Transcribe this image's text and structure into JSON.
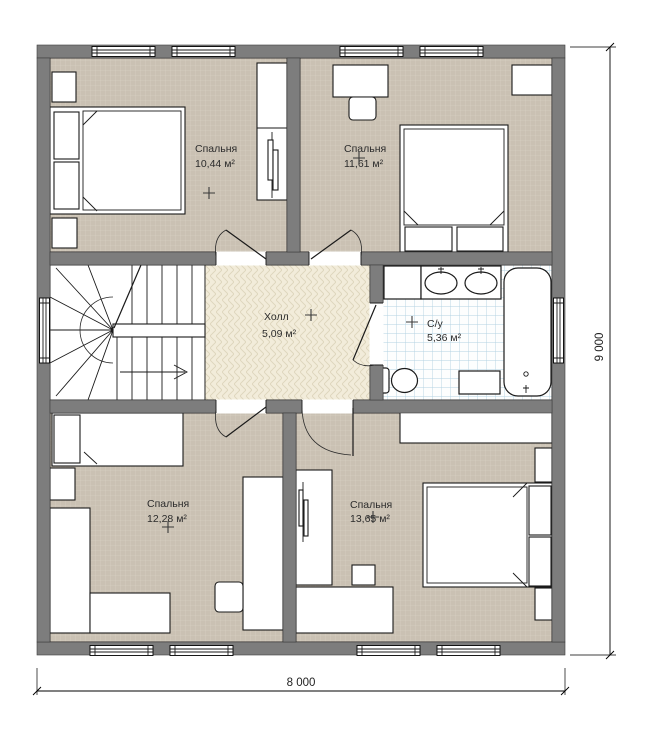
{
  "plan": {
    "rooms": [
      {
        "key": "bedroom-top-left",
        "name": "Спальня",
        "area": "10,44 м²"
      },
      {
        "key": "bedroom-top-right",
        "name": "Спальня",
        "area": "11,61 м²"
      },
      {
        "key": "hall",
        "name": "Холл",
        "area": "5,09 м²"
      },
      {
        "key": "bathroom",
        "name": "С/у",
        "area": "5,36 м²"
      },
      {
        "key": "bedroom-bottom-left",
        "name": "Спальня",
        "area": "12,28 м²"
      },
      {
        "key": "bedroom-bottom-right",
        "name": "Спальня",
        "area": "13,65 м²"
      }
    ],
    "dimensions": {
      "width_mm": "8 000",
      "height_mm": "9 000"
    },
    "colors": {
      "wall": "#7d7d7d",
      "carpet_floor": "#cac1b3",
      "carpet_line": "#d7cfc2",
      "hall_floor": "#f2ecda",
      "hall_line": "#ddd5bc",
      "tile_floor": "#fdfefe",
      "tile_line": "#b3d2e2",
      "outline": "#1a1a1a"
    }
  }
}
